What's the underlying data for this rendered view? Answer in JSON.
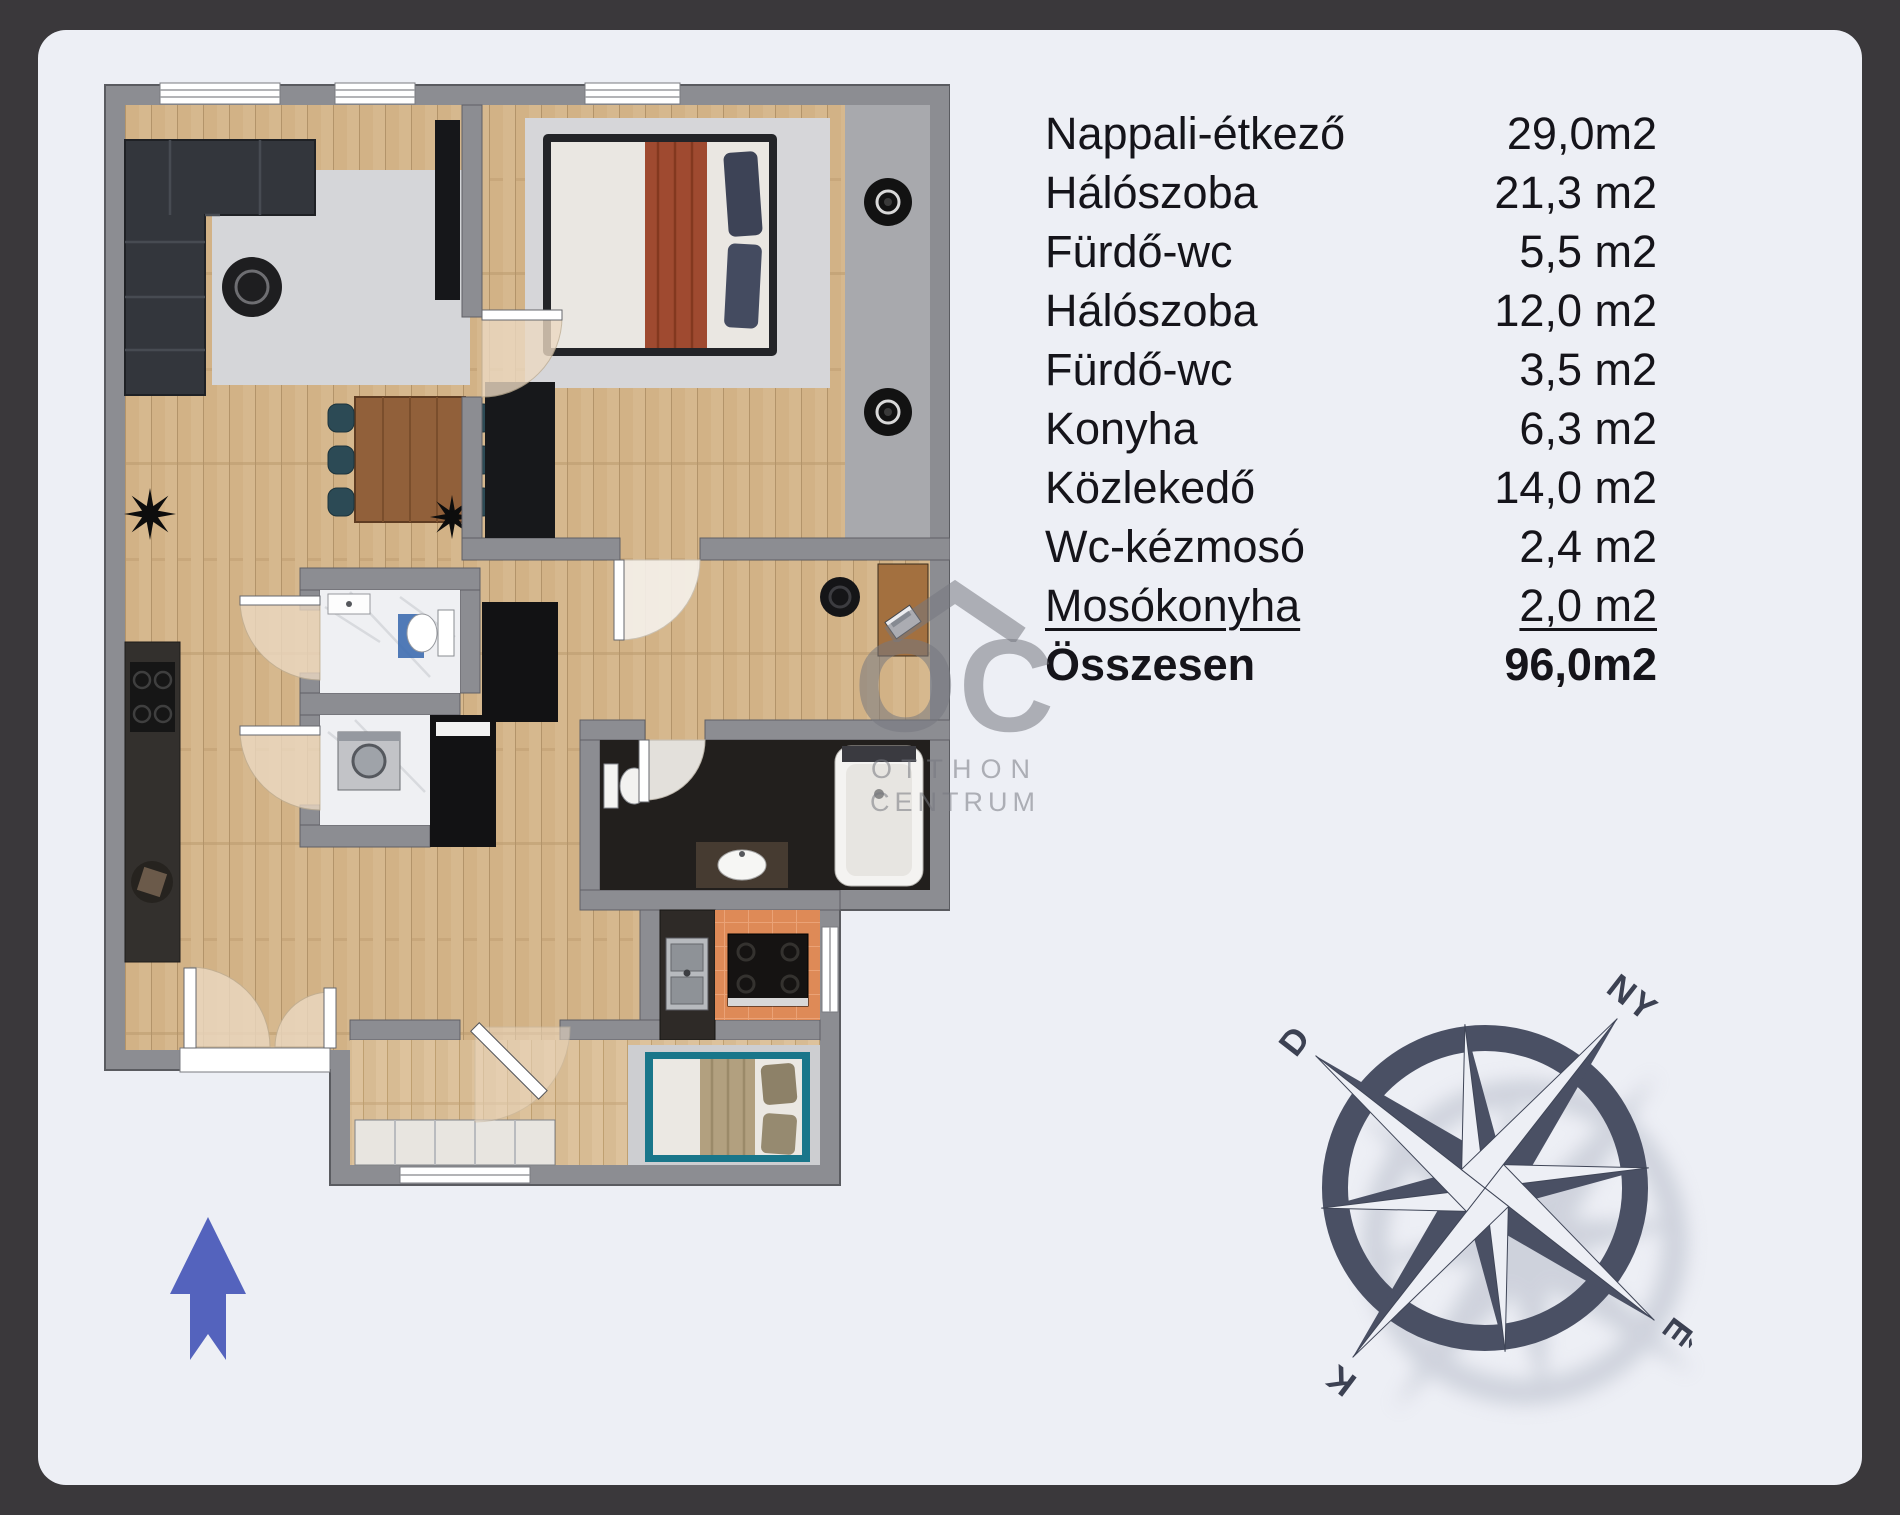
{
  "window": {
    "background": "#3a383b",
    "panel_color": "#edeff5"
  },
  "room_table": {
    "text_color": "#15141a",
    "rows": [
      {
        "label": "Nappali-étkező",
        "value": "29,0m2"
      },
      {
        "label": "Hálószoba",
        "value": "21,3 m2"
      },
      {
        "label": "Fürdő-wc",
        "value": "5,5 m2"
      },
      {
        "label": "Hálószoba",
        "value": "12,0 m2"
      },
      {
        "label": "Fürdő-wc",
        "value": "3,5 m2"
      },
      {
        "label": "Konyha",
        "value": "6,3 m2"
      },
      {
        "label": "Közlekedő",
        "value": "14,0 m2"
      },
      {
        "label": "Wc-kézmosó",
        "value": "2,4 m2"
      },
      {
        "label": "Mosókonyha",
        "value": "2,0 m2",
        "underline": true
      },
      {
        "label": "Összesen",
        "value": "96,0m2",
        "bold": true
      }
    ]
  },
  "watermark": {
    "letters": "OC",
    "line1": "OTTHON",
    "line2": "CENTRUM"
  },
  "compass": {
    "north": "É",
    "south": "D",
    "east": "K",
    "west": "NY",
    "color": "#4a5064"
  },
  "entrance_arrow_color": "#5463bd",
  "plan_colors": {
    "wall": "#8c8d92",
    "wood_floor": "#d6b88e",
    "bath_floor": "#221f1d",
    "kitchen_floor": "#de8a57",
    "marble_floor": "#eff0f3",
    "door_arc": "#ecd9c2"
  }
}
